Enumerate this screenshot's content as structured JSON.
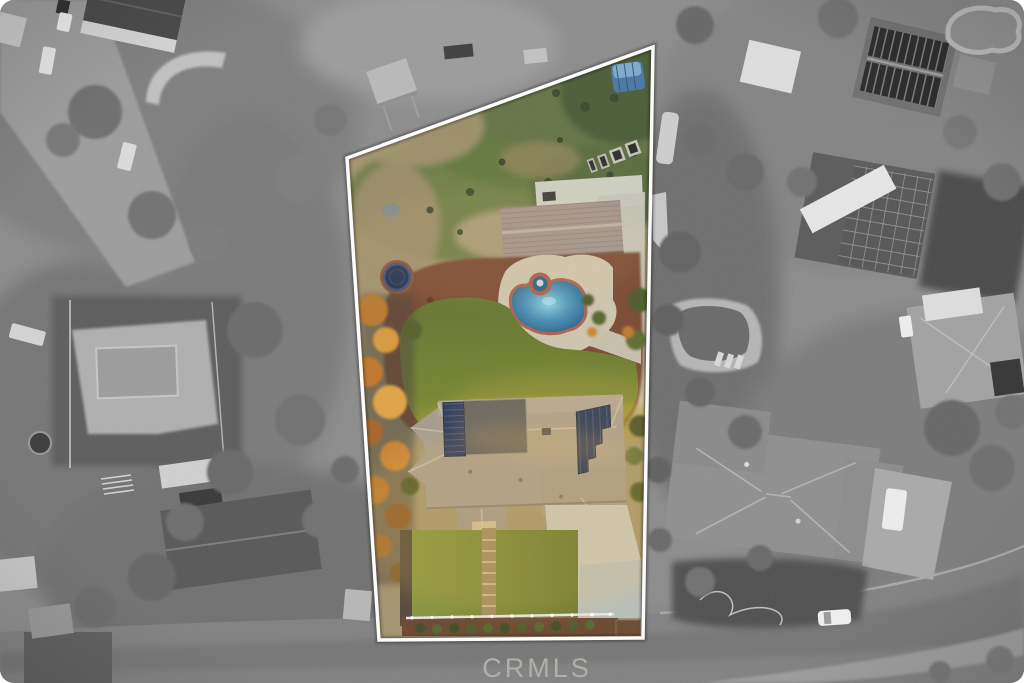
{
  "watermark": {
    "text": "CRMLS",
    "color": "#b7b3ac"
  },
  "parcel": {
    "border_color": "#ffffff",
    "features": [
      "back-field-patchy-grass",
      "blue-tarp-covered-boat",
      "raised-garden-beds",
      "detached-garage",
      "trampoline",
      "kidney-pool-with-spa",
      "backyard-lawn",
      "red-mulch-beds",
      "autumn-trees-west-edge",
      "main-house-hip-roof",
      "rooftop-solar-arrays",
      "east-concrete-driveway",
      "front-lawn-with-step-walkway",
      "white-street-fence"
    ]
  },
  "surroundings": {
    "style": "grayscale-aerial",
    "features": [
      "neighbor-house-dark-roof-top-left",
      "curved-retaining-wall",
      "solar-barn-top-right",
      "neighbor-pools",
      "large-hip-roof-house-bottom-right",
      "curved-street-with-white-car",
      "parked-cars-top-left",
      "boats-and-rv"
    ]
  },
  "palette": {
    "background_gray": "#8c8c8c",
    "road_gray": "#818181",
    "parcel_border": "#ffffff",
    "dirt_field": "#a3946f",
    "field_grass": "#5d7040",
    "mulch": "#7a4a32",
    "lawn": "#6f8030",
    "front_lawn": "#7d8c36",
    "pool_deck": "#cfc5ae",
    "pool_coping": "#ad5c46",
    "pool_water_deep": "#2f6f99",
    "roof_main": "#a59c8e",
    "roof_garage": "#a2938c",
    "solar_panel": "#22325a",
    "roof_dark_section": "#565a5e",
    "concrete": "#c7c6ba",
    "driveway_pad": "#b9bfba",
    "trampoline": "#23304e",
    "canopy_blue": "#4a76a4",
    "fence_white": "#e9e7e1",
    "autumn_tree": "#c9862f",
    "walkway": "#a08862"
  }
}
